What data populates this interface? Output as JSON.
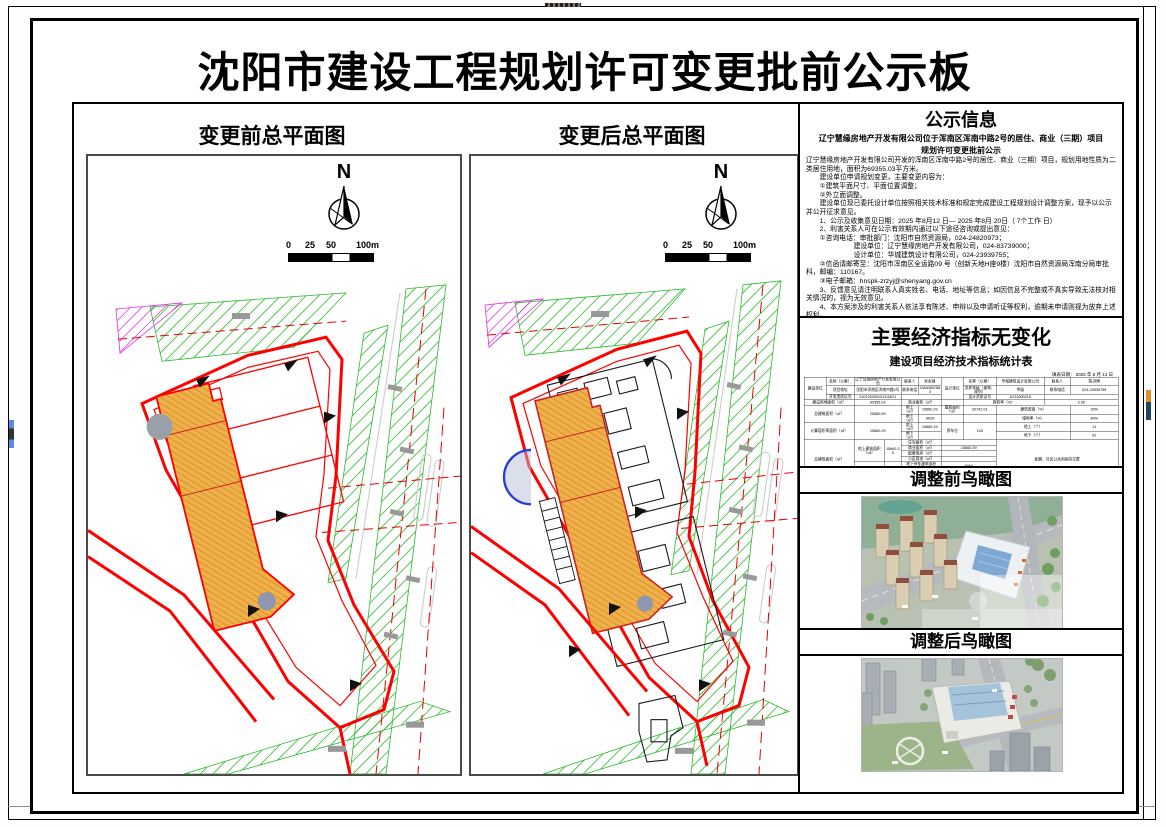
{
  "header": {
    "title": "沈阳市建设工程规划许可变更批前公示板"
  },
  "plans": {
    "before": {
      "title": "变更前总平面图"
    },
    "after": {
      "title": "变更后总平面图"
    },
    "compass_label": "N",
    "scale_ticks": [
      "0",
      "25",
      "50",
      "100m"
    ]
  },
  "notice": {
    "title": "公示信息",
    "subtitle_line1": "辽宁慧缘房地产开发有限公司位于浑南区浑南中路2号的居住、商业（三期）项目",
    "subtitle_line2": "规划许可变更批前公示",
    "paragraphs": [
      "辽宁慧缘房地产开发有限公司开发的浑南区浑南中路2号的居住、商业（三期）项目，规划用地性质为二类居住用地，面积为69355.03平方米。",
      "　　建设单位申请规划变更，主要变更内容为：",
      "　　①建筑平面尺寸、平面位置调整；",
      "　　②外立面调整。",
      "　　建设单位现已委托设计单位按照相关技术标准和规定完成建设工程规划设计调整方案，现予以公示并公开征求意见。",
      "　　1、公示及收集意见日期：2025 年8月12 日— 2025 年8月 20日（ 7个工作 日）",
      "　　2、利害关系人可在公示有效期内通过以下途径咨询或提出意见：",
      "　　①咨询电话：审批部门：沈阳市自然资源局，024-24820973；",
      "　　　　　　　建设单位：辽宁慧缘房地产开发有限公司，024-83739000；",
      "　　　　　　　设计单位：华城建筑设计有限公司，024-23939755；",
      "　　②信函请邮寄至：沈阳市浑南区全运路09 号（创新天地H座9楼）沈阳市自然资源局浑南分局审批科，邮编：110167。",
      "　　③电子邮箱：hnspk-zrzyj@shenyang.gov.cn",
      "　　3、反馈意见请注明联系人真实姓名、电话、地址等信息；如因信息不完整或不真实导致无法核对相关情况的，视为无效意见。",
      "　　4、本方案涉及的利害关系人依法享有陈述、申辩以及申请听证等权利，逾期未申请则视为放弃上述权利。"
    ],
    "signature": "沈阳市自然资源局",
    "date": "2025 年8月12日"
  },
  "econ": {
    "title": "主要经济指标无变化",
    "subtitle": "建设项目经济技术指标统计表",
    "date_line": "填表日期：  2025 年  6 月  14 日",
    "rows": [
      [
        {
          "t": "建设单位",
          "r": 3
        },
        {
          "t": "名称（公章）"
        },
        {
          "t": "辽宁慧缘房地产开发有限公司",
          "c": 2
        },
        {
          "t": "联系人"
        },
        {
          "t": "吴永强"
        },
        {
          "t": "设计单位",
          "r": 3
        },
        {
          "t": "名称（公章）"
        },
        {
          "t": "华城建筑设计有限公司"
        },
        {
          "t": "联系人"
        },
        {
          "t": "陈洪博"
        }
      ],
      [
        {
          "t": "项目地址"
        },
        {
          "t": "沈阳市浑南区浑南中路2号",
          "c": 2
        },
        {
          "t": "联系电话"
        },
        {
          "t": "13840897863"
        },
        {
          "t": "资质等级（建筑、规划）"
        },
        {
          "t": "甲级"
        },
        {
          "t": "联系电话"
        },
        {
          "t": "024-23939755",
          "c": 2
        }
      ],
      [
        {
          "t": "开发资质证号"
        },
        {
          "t": "210120000101110021",
          "c": 2
        },
        {
          "t": "",
          "c": 2
        },
        {
          "t": "设计资质证号"
        },
        {
          "t": "A121000218"
        },
        {
          "t": "",
          "c": 3
        }
      ],
      [
        {
          "t": "建设用地面积（㎡）",
          "c": 2
        },
        {
          "t": "69355.03",
          "c": 2
        },
        {
          "t": "商业面积（㎡）",
          "c": 2
        },
        {
          "t": ""
        },
        {
          "t": "容积率（%）",
          "c": 2
        },
        {
          "t": "0.35",
          "c": 2
        }
      ],
      [
        {
          "t": "总建筑面积（㎡）",
          "c": 2,
          "r": 2
        },
        {
          "t": "25080.59",
          "c": 2,
          "r": 2
        },
        {
          "t": "地上（㎡）"
        },
        {
          "t": "15660.29"
        },
        {
          "t": "基底面积（㎡）"
        },
        {
          "t": "20742.01"
        },
        {
          "t": "建筑密度（%）",
          "c": 2
        },
        {
          "t": "30%"
        }
      ],
      [
        {
          "t": "地下（㎡）"
        },
        {
          "t": "9420"
        },
        {
          "t": ""
        },
        {
          "t": ""
        },
        {
          "t": "绿地率（%）",
          "c": 2
        },
        {
          "t": "40%"
        }
      ],
      [
        {
          "t": "计算容积率面积（㎡）",
          "c": 2,
          "r": 2
        },
        {
          "t": "15660.29",
          "c": 2,
          "r": 2
        },
        {
          "t": "地上（㎡）"
        },
        {
          "t": "15660.29"
        },
        {
          "t": "停车位",
          "r": 2
        },
        {
          "t": "103",
          "r": 2
        },
        {
          "t": "地上（个）",
          "c": 2
        },
        {
          "t": "11"
        }
      ],
      [
        {
          "t": "地下（㎡）"
        },
        {
          "t": ""
        },
        {
          "t": "地下（个）",
          "c": 2
        },
        {
          "t": "92",
          "c": 2
        }
      ],
      [
        {
          "t": "总建筑面积（㎡）",
          "c": 2,
          "r": 6
        },
        {
          "t": "地上建筑面积（㎡）",
          "r": 4
        },
        {
          "t": "15660.39",
          "r": 4
        },
        {
          "t": "住宅面积（㎡）",
          "c": 2
        },
        {
          "t": "",
          "c": 2
        },
        {
          "t": "配套、社区公共用房的位置",
          "c": 3,
          "r": 6
        }
      ],
      [
        {
          "t": "商业面积（㎡）",
          "c": 2
        },
        {
          "t": "15660.39",
          "c": 2
        }
      ],
      [
        {
          "t": "配套用房（㎡）",
          "c": 2
        },
        {
          "t": "",
          "c": 2
        }
      ],
      [
        {
          "t": "小区用电（㎡）",
          "c": 2
        },
        {
          "t": "",
          "c": 2
        }
      ],
      [
        {
          "t": "地下建筑面积（㎡）",
          "r": 2
        },
        {
          "t": "9420",
          "r": 2
        },
        {
          "t": "地下停车建筑面积（㎡）",
          "c": 2
        },
        {
          "t": "8464",
          "c": 2
        }
      ],
      [
        {
          "t": "地下设备用房建筑面积（㎡）",
          "c": 2
        },
        {
          "t": "1256",
          "c": 2
        }
      ],
      [
        {
          "t": "住宅户型——“套型建筑面积”比例",
          "c": 2,
          "r": 2
        },
        {
          "t": "1套≤90㎡",
          "c": 2
        },
        {
          "t": "90㎡<1套≤135㎡",
          "c": 2
        },
        {
          "t": "135㎡<1套≤1050㎡",
          "c": 2
        },
        {
          "t": "其它（商业建筑面积等）",
          "c": 3
        }
      ],
      [
        {
          "t": "",
          "c": 2
        },
        {
          "t": "",
          "c": 2
        },
        {
          "t": "",
          "c": 2
        },
        {
          "t": "15660.39",
          "c": 3
        }
      ],
      [
        {
          "t": "新建楼栋数（个）",
          "c": 2
        },
        {
          "t": "",
          "c": 2
        },
        {
          "t": "",
          "c": 2
        },
        {
          "t": "",
          "c": 2
        },
        {
          "t": "01",
          "c": 3
        }
      ]
    ]
  },
  "aerials": {
    "before": {
      "title": "调整前鸟瞰图"
    },
    "after": {
      "title": "调整后鸟瞰图"
    }
  },
  "colors": {
    "boundary_red": "#ff0000",
    "greenbelt_green": "#2db92d",
    "reserve_magenta": "#e32ee3",
    "building_orange": "#f0b04a",
    "glass_blue": "#7ea9d2"
  }
}
